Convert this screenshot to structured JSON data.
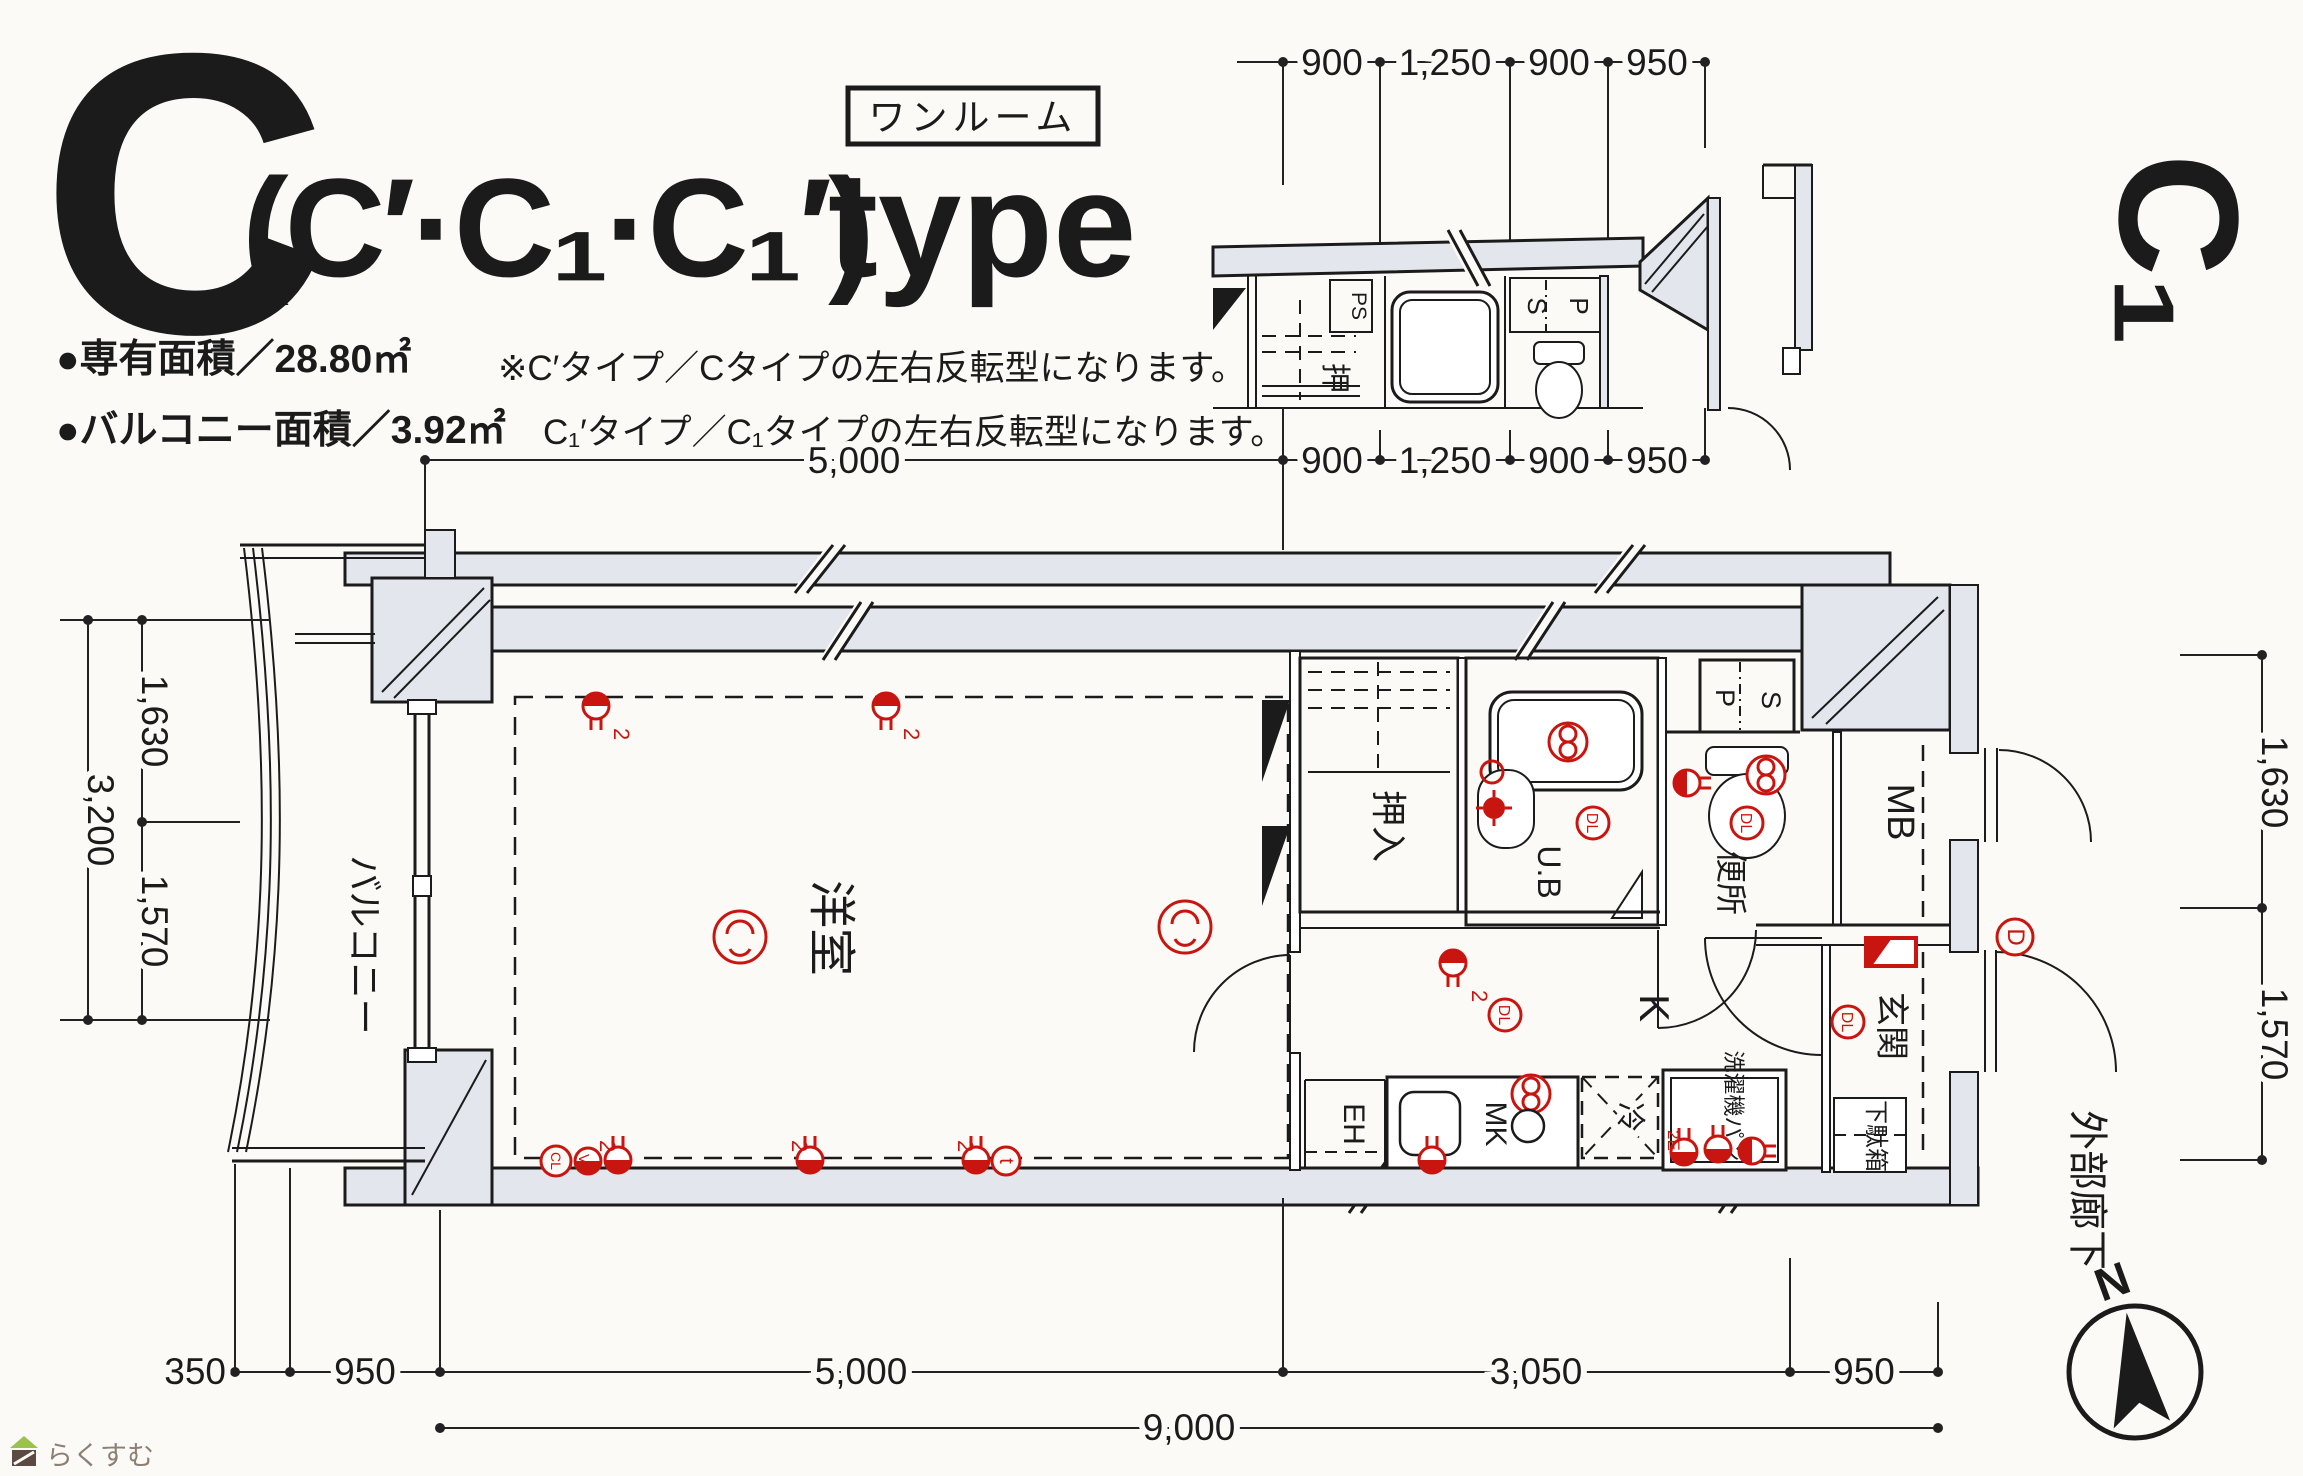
{
  "title": {
    "letter": "C",
    "paren": "(C′·C₁·C₁′)",
    "word": "type",
    "tag": "ワンルーム"
  },
  "areas": {
    "exclusive": "●専有面積／28.80㎡",
    "balcony": "●バルコニー面積／3.92㎡"
  },
  "notes": {
    "line1": "※C′タイプ／Cタイプの左右反転型になります。",
    "line2": "C₁′タイプ／C₁タイプの左右反転型になります。"
  },
  "side_label": "C₁",
  "compass": {
    "north": "N"
  },
  "watermark": "らくすむ",
  "dims": {
    "mini_top": [
      "900",
      "1,250",
      "900",
      "950"
    ],
    "mid": [
      "5,000",
      "900",
      "1,250",
      "900",
      "950"
    ],
    "left": [
      "1,630",
      "3,200",
      "1,570"
    ],
    "right": [
      "1,630",
      "1,570"
    ],
    "bottom": [
      "350",
      "950",
      "5,000",
      "3,050",
      "950"
    ],
    "total": "9,000"
  },
  "rooms": {
    "living": "洋室",
    "balcony": "バルコニー",
    "closet": "押入",
    "bath": "U.B",
    "toilet": "便所",
    "ps_p": "P",
    "ps_s": "S",
    "mb": "MB",
    "kitchen": "K",
    "eh": "EH",
    "mk": "MK",
    "fridge": "冷",
    "washer": "洗濯機パン",
    "shoebox": "下駄箱",
    "entrance": "玄関",
    "corridor": "外部廊下"
  },
  "mini": {
    "ps": "PS",
    "s": "S",
    "p": "P",
    "oshi": "押"
  },
  "symbols": {
    "dl": "DL",
    "d": "D",
    "t": "t",
    "cl": "CL",
    "v": "V",
    "two": "2",
    "two_e": "2E"
  },
  "colors": {
    "red": "#c9150f",
    "wall": "#e3e7ed",
    "ink": "#1b1b1b"
  }
}
